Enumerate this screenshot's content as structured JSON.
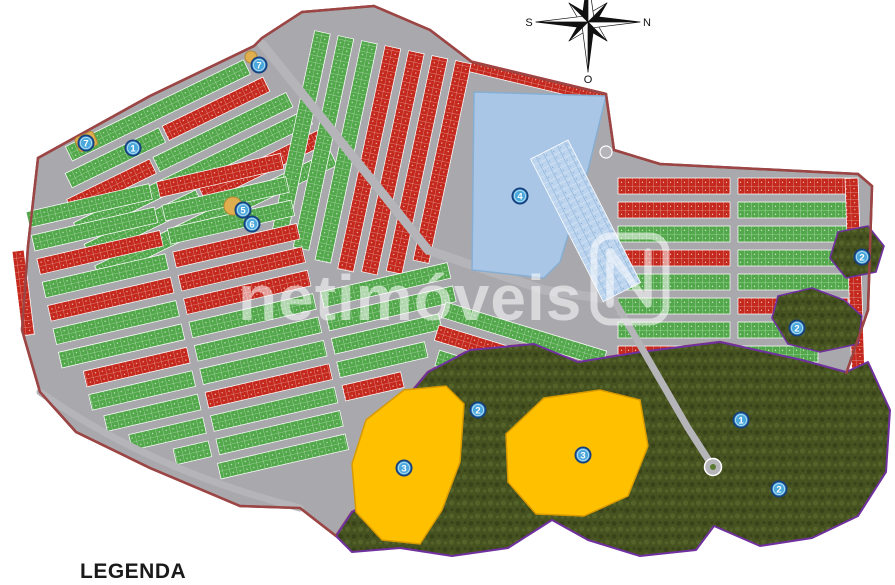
{
  "legend": {
    "title": "LEGENDA"
  },
  "watermark": {
    "text": "netimóveis",
    "logo_letter": "N"
  },
  "compass": {
    "right": "N",
    "left": "S",
    "bottom": "O"
  },
  "markers": [
    {
      "label": "7",
      "x": 259,
      "y": 65
    },
    {
      "label": "7",
      "x": 86,
      "y": 143
    },
    {
      "label": "1",
      "x": 133,
      "y": 148
    },
    {
      "label": "5",
      "x": 243,
      "y": 210
    },
    {
      "label": "6",
      "x": 252,
      "y": 224
    },
    {
      "label": "4",
      "x": 520,
      "y": 196
    },
    {
      "label": "2",
      "x": 478,
      "y": 410
    },
    {
      "label": "3",
      "x": 404,
      "y": 468
    },
    {
      "label": "3",
      "x": 583,
      "y": 455
    },
    {
      "label": "1",
      "x": 741,
      "y": 420
    },
    {
      "label": "2",
      "x": 797,
      "y": 328
    },
    {
      "label": "2",
      "x": 862,
      "y": 257
    },
    {
      "label": "2",
      "x": 779,
      "y": 489
    }
  ],
  "palette": {
    "background": "#ffffff",
    "road": "#a9a9ad",
    "roadLight": "#b5b5b9",
    "boundary": "#9c4545",
    "lotGreen": "#52a84b",
    "lotRed": "#c5281c",
    "lotBlue": "#bcd4ee",
    "lotBlueLine": "#6f9cc9",
    "lake": "#a9c6e6",
    "lakeEdge": "#86aed2",
    "forest": "#46521f",
    "forestDark": "#36421a",
    "forestLight": "#57662a",
    "forestOutline": "#7030a0",
    "orange": "#ffc000",
    "orangeEdge": "#d99a00",
    "plaza": "#dfae4e",
    "plazaEdge": "#b98a30",
    "markerFill": "#4aa8dc",
    "markerRing": "#16407e",
    "markerText": "#ffffff",
    "legendText": "#1a1a1a",
    "compassInk": "#111111"
  }
}
